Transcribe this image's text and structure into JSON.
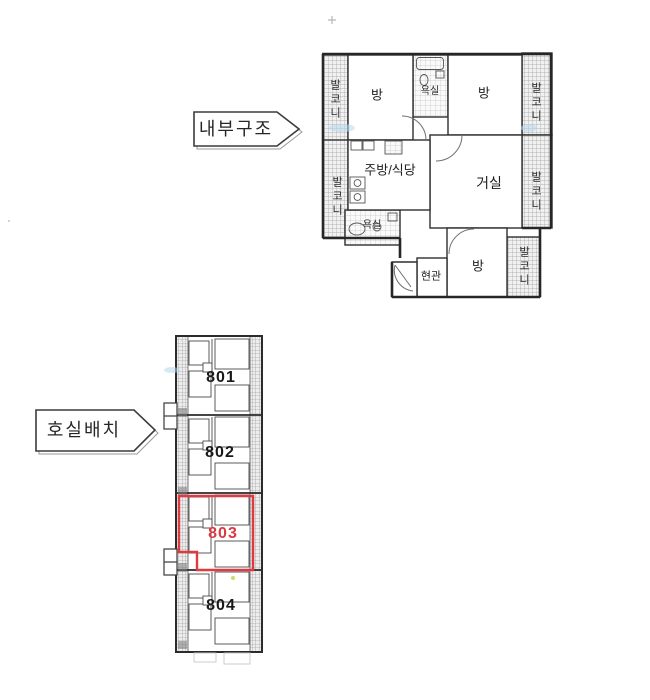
{
  "callouts": {
    "internal_structure": "내부구조",
    "unit_layout": "호실배치"
  },
  "internal_plan": {
    "rooms": {
      "room": "방",
      "bathroom": "욕실",
      "kitchen_dining": "주방/식당",
      "living_room": "거실",
      "entrance": "현관",
      "balcony": "발코니"
    }
  },
  "unit_plan": {
    "units": [
      {
        "number": "801",
        "highlighted": false
      },
      {
        "number": "802",
        "highlighted": false
      },
      {
        "number": "803",
        "highlighted": true
      },
      {
        "number": "804",
        "highlighted": false
      }
    ]
  },
  "colors": {
    "highlight_red": "#e03a40",
    "plan_line": "#2f2f2f",
    "hatch_gray": "#9e9e9e",
    "blue_smudge": "#b5d9ee"
  }
}
